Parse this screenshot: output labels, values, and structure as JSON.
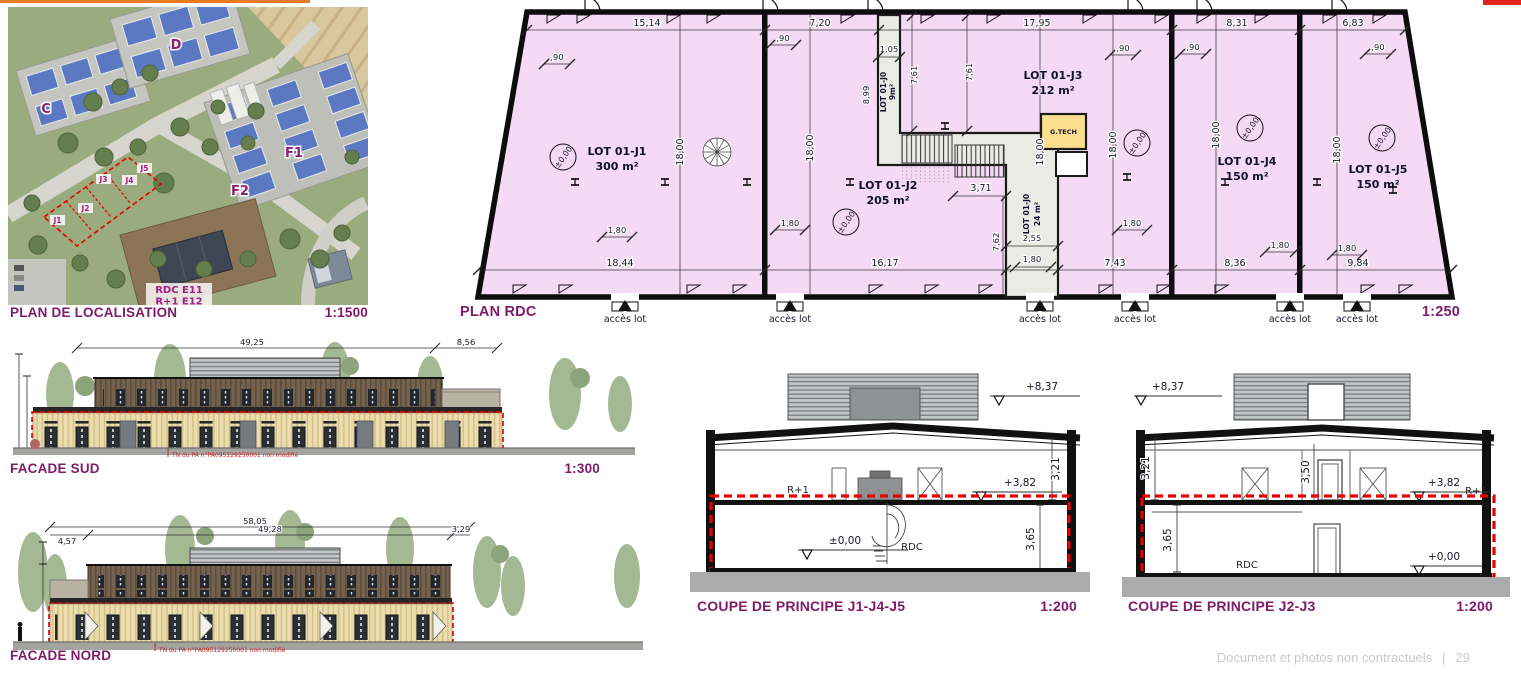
{
  "page": {
    "footer_note": "Document et photos non contractuels",
    "footer_separator": "|",
    "footer_page": "29"
  },
  "localisation": {
    "title": "PLAN DE LOCALISATION",
    "scale": "1:1500",
    "building_c": "C",
    "building_d": "D",
    "building_f1": "F1",
    "building_f2": "F2",
    "lot_j1": "J1",
    "lot_j2": "J2",
    "lot_j3": "J3",
    "lot_j4": "J4",
    "lot_j5": "J5",
    "annotation_line1": "RDC E11",
    "annotation_line2": "R+1 E12"
  },
  "plan_rdc": {
    "title": "PLAN RDC",
    "scale": "1:250",
    "lots": [
      {
        "name": "LOT 01-J1",
        "area": "300 m²"
      },
      {
        "name": "LOT 01-J2",
        "area": "205 m²"
      },
      {
        "name": "LOT 01-J3",
        "area": "212 m²"
      },
      {
        "name": "LOT 01-J4",
        "area": "150 m²"
      },
      {
        "name": "LOT 01-J5",
        "area": "150 m²"
      }
    ],
    "lot_j0_top": {
      "name": "LOT 01-J0",
      "area": "9m²"
    },
    "lot_j0_mid": {
      "name": "LOT 01-J0",
      "area": "24 m²"
    },
    "tech_room_label": "G.TECH",
    "level_marker": "±0,00",
    "dims_top": [
      "15,14",
      "7,20",
      "17,95",
      "8,31",
      "6,83"
    ],
    "dims_bottom": [
      "18,44",
      "16,17",
      "7,43",
      "8,36",
      "9,84"
    ],
    "dim_depth": "18,00",
    "dim_door": "1,80",
    "dim_door_small": ",90",
    "dim_corridor_width": "1,05",
    "dim_corridor_length": "8,99",
    "dim_7_61": "7,61",
    "dim_7_62": "7,62",
    "dim_3_71": "3,71",
    "dim_2_55": "2,55",
    "access_label": "accès lot"
  },
  "facade_sud": {
    "title": "FACADE SUD",
    "scale": "1:300",
    "dim_main": "49,25",
    "dim_annex": "8,56",
    "note": "TN du PA n°PA095129250001 non modifié"
  },
  "facade_nord": {
    "title": "FACADE NORD",
    "dim_total": "58,05",
    "dim_main": "49,28",
    "dim_left": "4,57",
    "dim_right": "3,29",
    "note": "TN du PA n°PA095129250001 non modifié"
  },
  "coupe_j1": {
    "title": "COUPE DE PRINCIPE J1-J4-J5",
    "scale": "1:200",
    "level_roof": "+8,37",
    "level_r1": "+3,82",
    "level_rdc": "±0,00",
    "height_r1": "3,21",
    "height_rdc": "3,65",
    "label_r1": "R+1",
    "label_rdc": "RDC"
  },
  "coupe_j2": {
    "title": "COUPE DE PRINCIPE J2-J3",
    "scale": "1:200",
    "level_roof": "+8,37",
    "level_r1": "+3,82",
    "level_rdc": "+0,00",
    "height_r1": "3,21",
    "height_mid": "3,50",
    "height_rdc": "3,65",
    "label_r1": "R+1",
    "label_rdc": "RDC"
  }
}
